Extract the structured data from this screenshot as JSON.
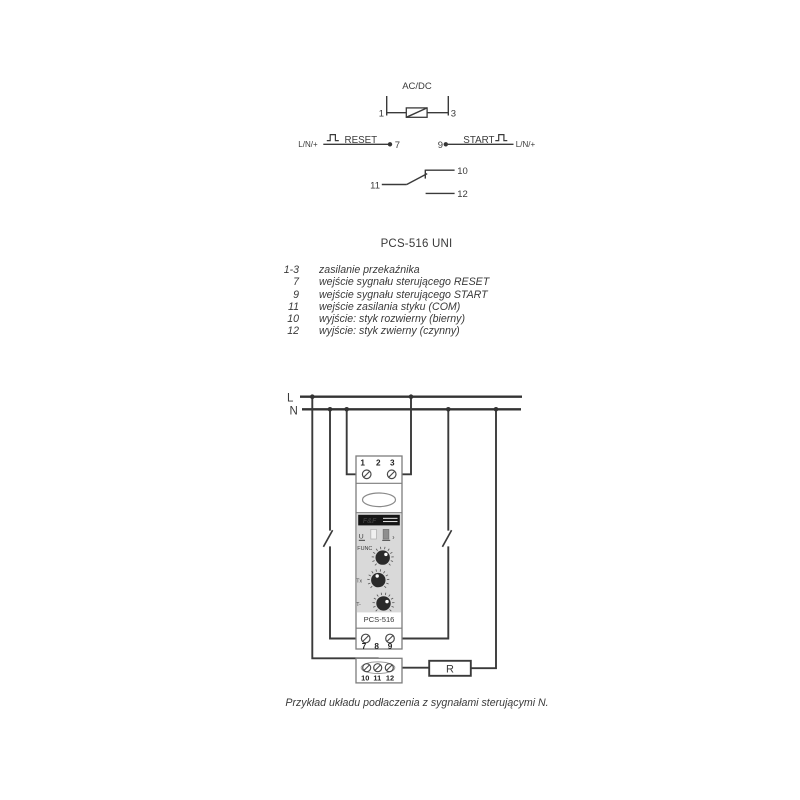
{
  "schematic": {
    "supply_label": "AC/DC",
    "terminal_1": "1",
    "terminal_3": "3",
    "reset": {
      "side_label": "L/N/+",
      "signal_label": "RESET",
      "terminal": "7"
    },
    "start": {
      "terminal": "9",
      "signal_label": "START",
      "side_label": "L/N/+"
    },
    "contact": {
      "com": "11",
      "nc_out": "10",
      "no_out": "12"
    }
  },
  "title": "PCS-516 UNI",
  "legend": {
    "rows": [
      {
        "num": "1-3",
        "desc": "zasilanie przekaźnika"
      },
      {
        "num": "7",
        "desc": "wejście sygnału sterującego RESET"
      },
      {
        "num": "9",
        "desc": "wejście sygnału sterującego START"
      },
      {
        "num": "11",
        "desc": "wejście zasilania styku (COM)"
      },
      {
        "num": "10",
        "desc": "wyjście: styk rozwierny (bierny)"
      },
      {
        "num": "12",
        "desc": "wyjście: styk zwierny (czynny)"
      }
    ]
  },
  "wiring": {
    "line_l": "L",
    "line_n": "N",
    "device": {
      "top_terminals": [
        "1",
        "2",
        "3"
      ],
      "brand": "F&F",
      "led_label_u": "U",
      "led_label_relay": "›",
      "knob1_label": "FUNC",
      "knob2_label": "Tx",
      "knob3_label": "T-",
      "model": "PCS-516",
      "mid_terminals": [
        "7",
        "8",
        "9"
      ],
      "bottom_terminals": [
        "10",
        "11",
        "12"
      ]
    },
    "load_label": "R"
  },
  "caption": "Przykład układu podłaczenia z sygnałami sterującymi N.",
  "colors": {
    "wire": "#3a3a3a",
    "device_outline": "#7d7d7d",
    "face_gray": "#d9d9d9",
    "logo_black": "#151515",
    "knob_dark": "#2b2b2b",
    "led_light": "#f0f0f0",
    "led_dark": "#8f8f8f",
    "background": "#ffffff"
  }
}
